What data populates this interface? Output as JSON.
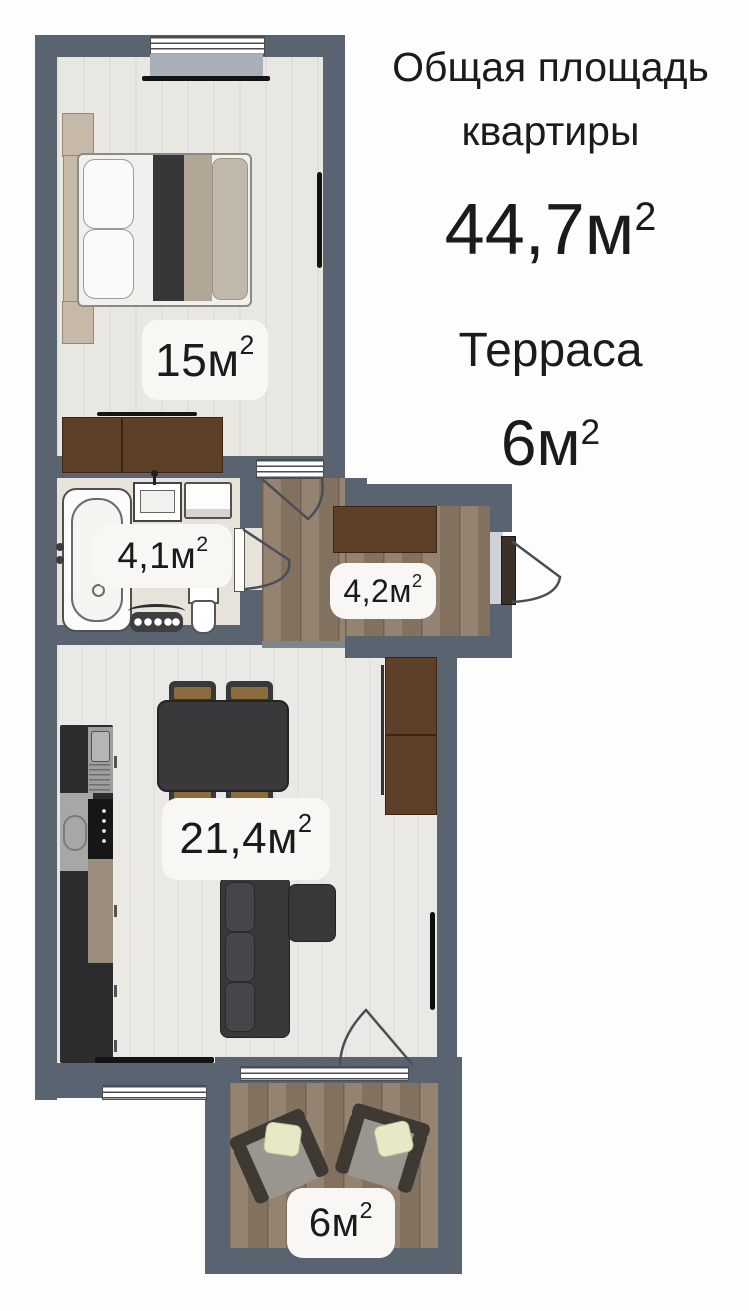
{
  "header": {
    "title_line1": "Общая площадь",
    "title_line2": "квартиры",
    "total_area": "44,7м",
    "total_area_sup": "2",
    "terrace_title": "Терраса",
    "terrace_area": "6м",
    "terrace_area_sup": "2"
  },
  "rooms": {
    "bedroom": {
      "area": "15м",
      "sup": "2"
    },
    "bathroom": {
      "area": "4,1м",
      "sup": "2"
    },
    "hallway": {
      "area": "4,2м",
      "sup": "2"
    },
    "living": {
      "area": "21,4м",
      "sup": "2"
    },
    "terrace": {
      "area": "6м",
      "sup": "2"
    }
  },
  "colors": {
    "wall": "#5a6370",
    "wood": "#8d7a67",
    "floor_light": "#ebe9e5",
    "floor_bedroom": "#e9e7e2",
    "floor_bath": "#e7e3db",
    "label_bg": "#f8f7f4",
    "text": "#1b1b1c",
    "furn_dark": "#38383b",
    "furn_brown": "#5e3f27",
    "kitchen_dark": "#2c2c2e",
    "chair_tan": "#8b6c3c",
    "pillow_green": "#e6e8c6"
  }
}
